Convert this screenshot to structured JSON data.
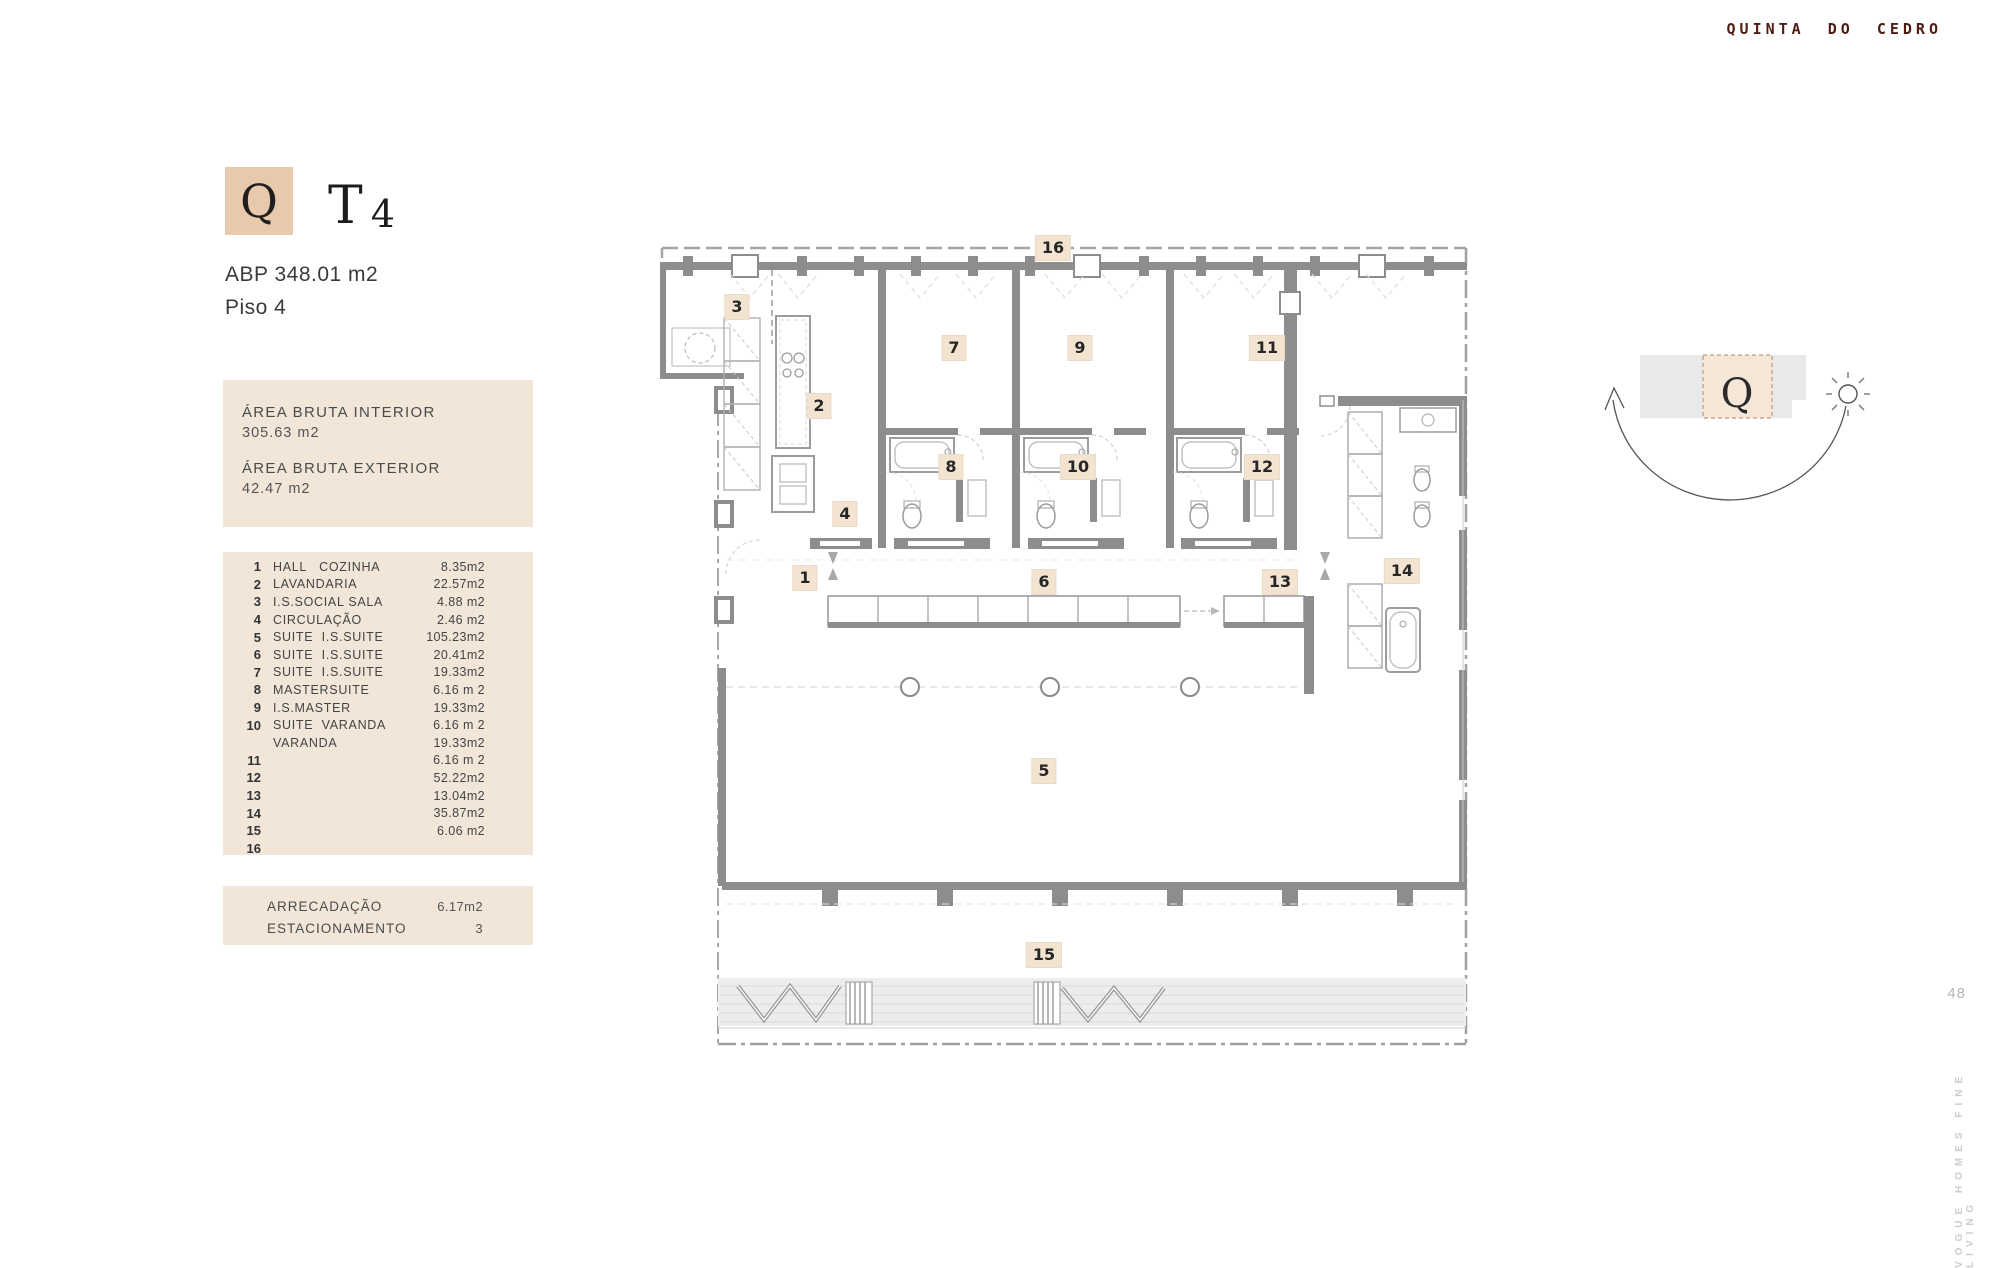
{
  "brand": "QUINTA DO CEDRO",
  "unit": {
    "badge_letter": "Q",
    "type_prefix": "T",
    "type_number": "4",
    "abp": "ABP 348.01 m2",
    "floor": "Piso 4"
  },
  "areas": {
    "interior_label": "ÁREA BRUTA INTERIOR",
    "interior_value": "305.63 m2",
    "exterior_label": "ÁREA BRUTA EXTERIOR",
    "exterior_value": "42.47 m2"
  },
  "room_table": {
    "rows": [
      {
        "num": "1",
        "label": "HALL   COZINHA",
        "value": "8.35m2"
      },
      {
        "num": "2",
        "label": "LAVANDARIA",
        "value": "22.57m2"
      },
      {
        "num": "3",
        "label": "I.S.SOCIAL SALA",
        "value": "4.88 m2"
      },
      {
        "num": "4",
        "label": "CIRCULAÇÃO",
        "value": "2.46 m2"
      },
      {
        "num": "5",
        "label": "SUITE  I.S.SUITE",
        "value": "105.23m2"
      },
      {
        "num": "6",
        "label": "SUITE  I.S.SUITE",
        "value": "20.41m2"
      },
      {
        "num": "7",
        "label": "SUITE  I.S.SUITE",
        "value": "19.33m2"
      },
      {
        "num": "8",
        "label": "MASTERSUITE",
        "value": "6.16 m 2"
      },
      {
        "num": "9",
        "label": "I.S.MASTER",
        "value": "19.33m2"
      },
      {
        "num": "10",
        "label": "SUITE  VARANDA",
        "value": "6.16 m 2"
      },
      {
        "num": "",
        "label": "VARANDA",
        "value": "19.33m2"
      },
      {
        "num": "11",
        "label": "",
        "value": "6.16 m 2"
      },
      {
        "num": "12",
        "label": "",
        "value": "52.22m2"
      },
      {
        "num": "13",
        "label": "",
        "value": "13.04m2"
      },
      {
        "num": "14",
        "label": "",
        "value": "35.87m2"
      },
      {
        "num": "15",
        "label": "",
        "value": "6.06 m2"
      },
      {
        "num": "16",
        "label": "",
        "value": ""
      }
    ]
  },
  "extras": {
    "rows": [
      {
        "label": "ARRECADAÇÃO",
        "value": "6.17m2"
      },
      {
        "label": "ESTACIONAMENTO",
        "value": "3"
      }
    ]
  },
  "plan": {
    "badges": [
      {
        "num": "16",
        "x": 393,
        "y": 8
      },
      {
        "num": "3",
        "x": 77,
        "y": 67
      },
      {
        "num": "2",
        "x": 159,
        "y": 166
      },
      {
        "num": "7",
        "x": 294,
        "y": 108
      },
      {
        "num": "9",
        "x": 420,
        "y": 108
      },
      {
        "num": "11",
        "x": 607,
        "y": 108
      },
      {
        "num": "8",
        "x": 291,
        "y": 227
      },
      {
        "num": "10",
        "x": 418,
        "y": 227
      },
      {
        "num": "12",
        "x": 602,
        "y": 227
      },
      {
        "num": "4",
        "x": 185,
        "y": 274
      },
      {
        "num": "1",
        "x": 145,
        "y": 338
      },
      {
        "num": "6",
        "x": 384,
        "y": 342
      },
      {
        "num": "13",
        "x": 620,
        "y": 342
      },
      {
        "num": "14",
        "x": 742,
        "y": 331
      },
      {
        "num": "5",
        "x": 384,
        "y": 531
      },
      {
        "num": "15",
        "x": 384,
        "y": 715
      }
    ]
  },
  "compass": {
    "letter": "Q"
  },
  "footer": {
    "page_number": "48",
    "side_text": "VOGUE HOMES FINE LIVING"
  }
}
